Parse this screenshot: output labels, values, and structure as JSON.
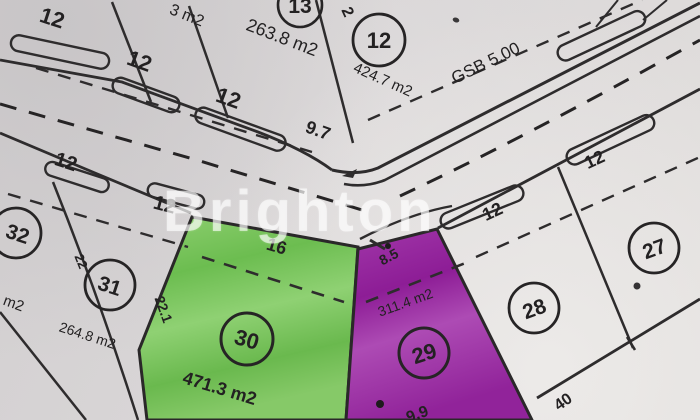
{
  "watermark": "Brighton",
  "map": {
    "annotation_gsb": "GSB 5.00",
    "numbers": {
      "p13": "13",
      "p12": "12",
      "p32": "32",
      "p31": "31",
      "p30": "30",
      "p29": "29",
      "p28": "28",
      "p27": "27"
    },
    "labels": {
      "top_frontage_1": "12",
      "top_frontage_2": "12",
      "top_frontage_3": "12",
      "area_partial_top": "3 m2",
      "area_13": "263.8 m2",
      "side_13": "2",
      "area_12": "424.7 m2",
      "corner_9_7": "9.7",
      "left_frontage_1": "12",
      "left_frontage_2": "12",
      "area_partial_32": "m2",
      "depth_31": "22",
      "area_31": "264.8 m2",
      "width_30": "16",
      "depth_30": "22.1",
      "area_30": "471.3 m2",
      "width_29": "8.5",
      "area_29": "311.4 m2",
      "bottom_29": "9.9",
      "right_frontage_1": "12",
      "right_frontage_2": "12",
      "rear_40": "40"
    },
    "colors": {
      "paper": "#d9d6d7",
      "ink": "#2e2c2d",
      "green_highlight": "#7cc55f",
      "purple_highlight": "#9b2fa3",
      "watermark_color": "#ffffff"
    }
  }
}
